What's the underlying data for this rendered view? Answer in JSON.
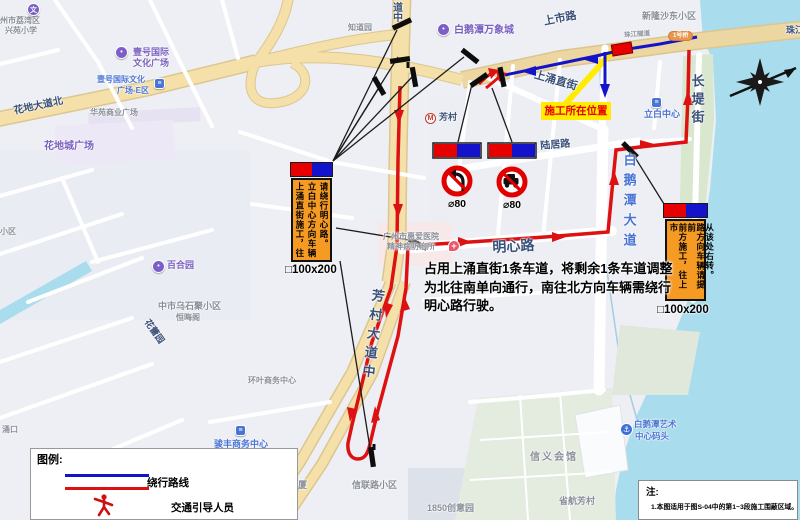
{
  "colors": {
    "land": "#edeff4",
    "water": "#a9dcec",
    "road_major": "#f4e0a8",
    "road_casing": "#dcc68f",
    "green": "#d9e7cf",
    "route_red": "#dd1111",
    "route_blue": "#1313cc",
    "callout_yellow": "#ffec00",
    "sign_orange": "#f59a23",
    "plate_red": "#e60000",
    "plate_blue": "#1313cc",
    "barrier_red": "#e60000",
    "bar_black": "#0d0d0d"
  },
  "callout": {
    "text": "施工所在位置"
  },
  "description": {
    "lines": [
      "占用上涌直街1条车道，将剩余1条车道调整",
      "为北往南单向通行，南往北方向车辆需绕行",
      "明心路行驶。"
    ]
  },
  "signs": {
    "left_board": {
      "columns": [
        "上涌直街施工，往",
        "立白中心方向车辆",
        "请绕行明心路。"
      ],
      "size_label": "□100x200"
    },
    "right_board": {
      "columns": [
        "前方施工，往上市",
        "路方向车辆请提前",
        "从该处右转。"
      ],
      "size_label": "□100x200"
    },
    "no_left_turn": {
      "size_label": "⌀80"
    },
    "no_motor": {
      "size_label": "⌀80"
    }
  },
  "legend": {
    "title": "图例:",
    "items": [
      {
        "icon": "detour-route-lines",
        "label": "绕行路线"
      },
      {
        "icon": "guide-person-icon",
        "label": "交通引导人员"
      }
    ]
  },
  "note": {
    "title": "注:",
    "lines": [
      "1.本图适用于图S-04中的第1~3段施工围蔽区域。"
    ]
  },
  "map_labels": [
    {
      "t": "州市荔湾区",
      "x": 0,
      "y": 17,
      "c": "gray",
      "s": 8,
      "n": "district-label"
    },
    {
      "t": "兴苑小学",
      "x": 5,
      "y": 27,
      "c": "gray",
      "s": 8,
      "n": "school-label"
    },
    {
      "t": "壹号国际",
      "x": 133,
      "y": 48,
      "c": "purple",
      "s": 9,
      "n": "poi-label"
    },
    {
      "t": "文化广场",
      "x": 133,
      "y": 59,
      "c": "purple",
      "s": 9,
      "n": "poi-label"
    },
    {
      "t": "壹号国际文化",
      "x": 97,
      "y": 76,
      "c": "blue",
      "s": 8,
      "n": "poi-label"
    },
    {
      "t": "广场-E区",
      "x": 117,
      "y": 87,
      "c": "blue",
      "s": 8,
      "n": "poi-label"
    },
    {
      "t": "花地大道北",
      "x": 13,
      "y": 107,
      "c": "navy",
      "s": 10,
      "r": -12,
      "n": "road-label-huadi-north"
    },
    {
      "t": "华苑商业广场",
      "x": 90,
      "y": 109,
      "c": "gray",
      "s": 8,
      "n": "poi-label"
    },
    {
      "t": "花地城广场",
      "x": 44,
      "y": 142,
      "c": "purple",
      "s": 10,
      "n": "poi-label"
    },
    {
      "t": "知道园",
      "x": 348,
      "y": 24,
      "c": "gray",
      "s": 8,
      "n": "poi-label"
    },
    {
      "t": "道中",
      "x": 390,
      "y": 2,
      "c": "navy",
      "s": 10,
      "v": true,
      "n": "road-label-partial"
    },
    {
      "t": "白鹅潭万象城",
      "x": 454,
      "y": 26,
      "c": "purple",
      "s": 10,
      "n": "poi-label-mall"
    },
    {
      "t": "芳村",
      "x": 439,
      "y": 113,
      "c": "navy",
      "s": 9,
      "n": "metro-station-label"
    },
    {
      "t": "上市路",
      "x": 543,
      "y": 17,
      "c": "navy",
      "s": 11,
      "r": -11,
      "n": "road-label-shangshi"
    },
    {
      "t": "新隆沙东小区",
      "x": 642,
      "y": 12,
      "c": "gray",
      "s": 9,
      "n": "estate-label"
    },
    {
      "t": "珠江隧道",
      "x": 624,
      "y": 33,
      "c": "gray",
      "s": 6.5,
      "r": -4,
      "n": "road-label-small"
    },
    {
      "t": "珠江隧道",
      "x": 786,
      "y": 26,
      "c": "navy",
      "s": 9,
      "n": "road-label-zhujiang-tunnel"
    },
    {
      "t": "上涌直街",
      "x": 536,
      "y": 70,
      "c": "navy",
      "s": 11,
      "r": 16,
      "n": "road-label-shangyong"
    },
    {
      "t": "立白中心",
      "x": 644,
      "y": 110,
      "c": "blue",
      "s": 9,
      "n": "poi-label-liby"
    },
    {
      "t": "陆居路",
      "x": 540,
      "y": 142,
      "c": "navy",
      "s": 10,
      "r": -5,
      "n": "road-label-luju"
    },
    {
      "t": "白鹅潭大道",
      "x": 622,
      "y": 153,
      "c": "blue",
      "s": 13,
      "v": true,
      "ls": 7,
      "n": "road-label-baietan"
    },
    {
      "t": "长堤街",
      "x": 690,
      "y": 74,
      "c": "navy",
      "s": 13,
      "v": true,
      "ls": 5,
      "n": "road-label-changdi"
    },
    {
      "t": "明心路",
      "x": 492,
      "y": 240,
      "c": "navy",
      "s": 14,
      "r": -3,
      "n": "road-label-mingxin"
    },
    {
      "t": "广州市惠爱医院",
      "x": 383,
      "y": 233,
      "c": "gray",
      "s": 8,
      "n": "hospital-label"
    },
    {
      "t": "精神病防治所",
      "x": 387,
      "y": 243,
      "c": "gray",
      "s": 8,
      "n": "hospital-label"
    },
    {
      "t": "小区",
      "x": 0,
      "y": 228,
      "c": "gray",
      "s": 8,
      "n": "estate-label"
    },
    {
      "t": "百合园",
      "x": 167,
      "y": 261,
      "c": "purple",
      "s": 9,
      "n": "poi-label"
    },
    {
      "t": "中市乌石聚小区",
      "x": 158,
      "y": 302,
      "c": "gray",
      "s": 9,
      "n": "estate-label"
    },
    {
      "t": "恒晦阁",
      "x": 176,
      "y": 314,
      "c": "gray",
      "s": 8,
      "n": "poi-label"
    },
    {
      "t": "花蕾园",
      "x": 150,
      "y": 318,
      "c": "navy",
      "s": 9,
      "r": 55,
      "n": "road-label"
    },
    {
      "t": "芳村大道中",
      "x": 371,
      "y": 288,
      "c": "navy",
      "s": 13,
      "v": true,
      "ls": 6,
      "r": 7,
      "n": "road-label-fangcun"
    },
    {
      "t": "环叶商务中心",
      "x": 248,
      "y": 377,
      "c": "gray",
      "s": 8,
      "n": "poi-label"
    },
    {
      "t": "骏丰商务中心",
      "x": 214,
      "y": 440,
      "c": "blue",
      "s": 9,
      "n": "poi-label"
    },
    {
      "t": "加怡大厦",
      "x": 271,
      "y": 481,
      "c": "gray",
      "s": 9,
      "n": "poi-label"
    },
    {
      "t": "信联路小区",
      "x": 352,
      "y": 481,
      "c": "gray",
      "s": 9,
      "n": "estate-label"
    },
    {
      "t": "1850创意园",
      "x": 427,
      "y": 504,
      "c": "gray",
      "s": 9,
      "n": "poi-label"
    },
    {
      "t": "芳村大道东小区",
      "x": 228,
      "y": 511,
      "c": "gray",
      "s": 9,
      "n": "estate-label"
    },
    {
      "t": "信义会馆",
      "x": 530,
      "y": 453,
      "c": "gray",
      "s": 10,
      "ls": 2,
      "n": "poi-label"
    },
    {
      "t": "省航芳村",
      "x": 559,
      "y": 497,
      "c": "gray",
      "s": 9,
      "n": "poi-label"
    },
    {
      "t": "白鹅潭艺术",
      "x": 634,
      "y": 420,
      "c": "blue",
      "s": 8.5,
      "n": "poi-label-pier"
    },
    {
      "t": "中心码头",
      "x": 635,
      "y": 432,
      "c": "blue",
      "s": 8.5,
      "n": "poi-label-pier"
    },
    {
      "t": "涌口",
      "x": 2,
      "y": 426,
      "c": "gray",
      "s": 8,
      "n": "place-label"
    }
  ],
  "pins": [
    {
      "kind": "pin-purple",
      "glyph": "文",
      "x": 27,
      "y": 3,
      "n": "school-pin"
    },
    {
      "kind": "pin-purple",
      "glyph": "•",
      "x": 115,
      "y": 46,
      "n": "culture-plaza-pin"
    },
    {
      "kind": "icon-blue",
      "glyph": "≡",
      "x": 154,
      "y": 78,
      "n": "building-icon"
    },
    {
      "kind": "pin-purple",
      "glyph": "•",
      "x": 437,
      "y": 23,
      "n": "mall-pin"
    },
    {
      "kind": "pin-metro",
      "glyph": "M",
      "x": 425,
      "y": 113,
      "n": "metro-icon"
    },
    {
      "kind": "icon-blue",
      "glyph": "≡",
      "x": 651,
      "y": 97,
      "n": "building-icon"
    },
    {
      "kind": "pin-hospital",
      "glyph": "+",
      "x": 448,
      "y": 240,
      "n": "hospital-pin"
    },
    {
      "kind": "pin-purple",
      "glyph": "•",
      "x": 152,
      "y": 260,
      "n": "garden-pin"
    },
    {
      "kind": "icon-blue",
      "glyph": "≡",
      "x": 235,
      "y": 425,
      "n": "building-icon"
    },
    {
      "kind": "pin-ferry",
      "glyph": "⚓",
      "x": 620,
      "y": 423,
      "n": "ferry-pier-icon"
    },
    {
      "kind": "badge",
      "glyph": "1号桥",
      "x": 668,
      "y": 31,
      "n": "road-badge"
    }
  ]
}
